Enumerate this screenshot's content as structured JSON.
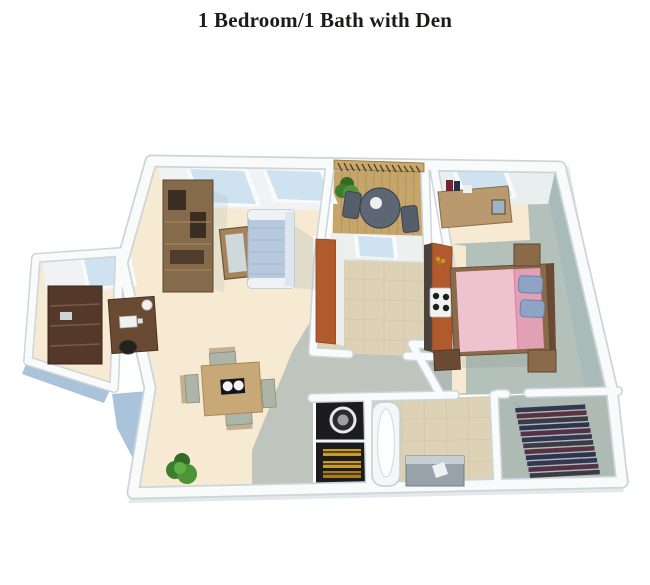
{
  "title": "1 Bedroom/1 Bath with Den",
  "title_color": "#1f1a1a",
  "rooms": [
    "living-room",
    "dining-area",
    "den",
    "balcony",
    "kitchen",
    "bedroom",
    "bedroom-closet",
    "bathroom",
    "laundry-closet",
    "walk-in-closet",
    "hallway",
    "entry"
  ],
  "palette": {
    "background": "#ffffff",
    "wall_white": "#f9fafa",
    "wall_edge": "#ccd5da",
    "exterior_blue": "#a9c3da",
    "outer_shadow": "#e2e8ec",
    "carpet_cream": "#f6ead2",
    "walkway_gray": "#bfc5bc",
    "tile_beige": "#ddd2b6",
    "bedroom_carpet": "#b4c1ba",
    "bedroom_wall": "#a8bbb9",
    "closet_carpet": "#aebbb4",
    "deck_wood": "#c6a56b",
    "railing_wood": "#caa868",
    "counter_orange": "#b15a2e",
    "cabinet_dark": "#4a423c",
    "wood_brown": "#856a4c",
    "wood_dark": "#54392b",
    "desk_wood": "#6b4a33",
    "sofa_blue": "#b9c9dd",
    "bed_pink": "#e2a0b6",
    "bed_pink_light": "#efc2d0",
    "pillow_blue": "#8fa3c6",
    "plant_green": "#3f7d2e",
    "laundry_black": "#1c1c1e",
    "towel_gold": "#c99b27",
    "tub_white": "#f4f7f7",
    "vanity_gray": "#97a2aa",
    "window_blue": "#cfe2f0",
    "table_tan": "#c9a877",
    "wall_face": "#f0f2f3"
  }
}
